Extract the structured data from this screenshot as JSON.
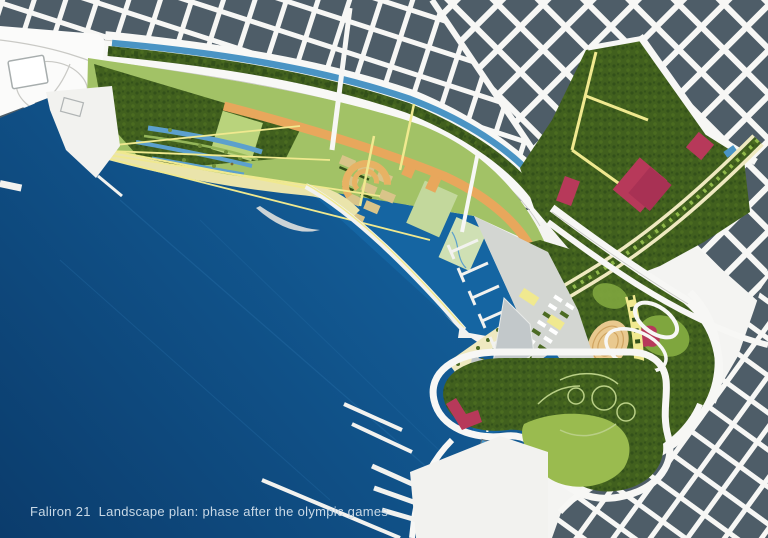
{
  "caption": "Faliron 21  Landscape plan: phase after the olympic games",
  "palette": {
    "sea-deep": "#0b3c6c",
    "sea-light": "#1668a6",
    "sea-streak": "#2a74ad",
    "marina-water": "#1565a2",
    "canal": "#4a94c4",
    "wetland": "#5ca0cd",
    "city-block": "#4e5d68",
    "street": "#f7f7f5",
    "road-line": "#c9c9c5",
    "forest-base": "#41601e",
    "forest-dark": "#33511a",
    "forest-mid": "#4b6c20",
    "lawn": "#a2c266",
    "lawn-bright": "#9abb4f",
    "lawn-mid": "#7fa63e",
    "field-light": "#b9d37c",
    "field-pale": "#cfe0b4",
    "field-green": "#c3d89c",
    "sand": "#eae4ab",
    "path-yellow": "#f0e98f",
    "path-pale": "#efe9c0",
    "promenade-orange": "#e8a75c",
    "plot-tan": "#d9c489",
    "stadium-tan": "#e9c98f",
    "stadium-line": "#cfa35f",
    "building-red": "#b7395a",
    "building-red-dark": "#a83154",
    "pier-white": "#f2f2ef",
    "pier-gray": "#c2c8ca",
    "esplanade-gray": "#d3d6d2",
    "boat-yellow": "#ecc95c",
    "park-path": "#b9cf86",
    "tree-dot": "#4c6b23",
    "caption-color": "#c9d9e6"
  }
}
